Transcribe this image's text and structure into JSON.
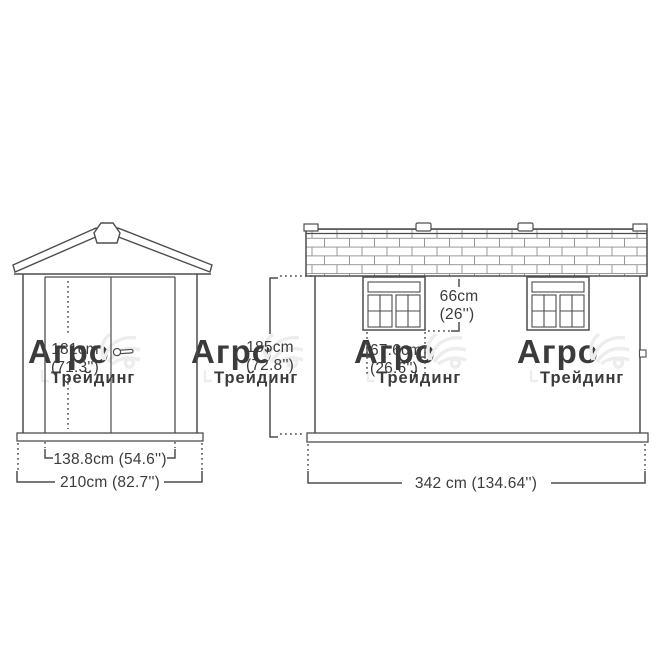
{
  "meta": {
    "description": "Dimensional line drawing of a garden shed, front and side elevations",
    "background_color": "#ffffff",
    "line_color": "#4d4d4d",
    "text_color": "#3b3b3b",
    "watermark_color": "#ededed"
  },
  "front_view": {
    "name": "front elevation with double doors and gable roof",
    "height_cm": "181cm",
    "height_in": "(71.3'')",
    "door_width_label": "138.8cm (54.6'')",
    "overall_width_label": "210cm (82.7'')"
  },
  "side_view": {
    "name": "side elevation with shingled roof and two windows",
    "height_cm": "185cm",
    "height_in": "(72.8'')",
    "window_height_cm": "66cm",
    "window_height_in": "(26'')",
    "window_width_cm": "67.6cm",
    "window_width_in": "(26.6'')",
    "overall_length_label": "342 cm (134.64'')"
  },
  "watermark": {
    "brand": "Агро",
    "sub": "Трейдинг"
  }
}
